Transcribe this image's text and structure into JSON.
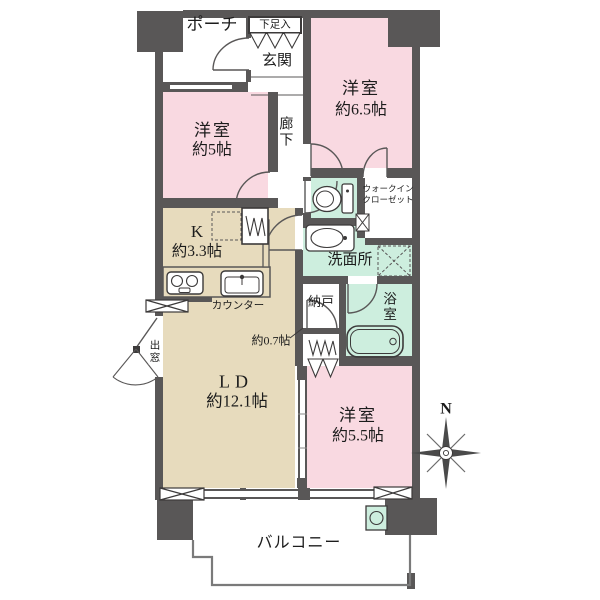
{
  "fp": {
    "rooms": {
      "porch": "ポーチ",
      "shoe_box": "下足入",
      "entrance": "玄関",
      "bedroom_ne_name": "洋室",
      "bedroom_ne_size": "約6.5帖",
      "bedroom_w_name": "洋室",
      "bedroom_w_size": "約5帖",
      "corridor": "廊下",
      "wic_line1": "ウォークイン",
      "wic_line2": "クローゼット",
      "washroom": "洗面所",
      "kitchen_name": "K",
      "kitchen_size": "約3.3帖",
      "counter": "カウンター",
      "storage": "納戸",
      "storage_size": "約0.7帖",
      "bath": "浴室",
      "living_name": "LD",
      "living_size": "約12.1帖",
      "bedroom_se_name": "洋室",
      "bedroom_se_size": "約5.5帖",
      "balcony": "バルコニー",
      "bay_window": "出窓",
      "compass_north": "N"
    },
    "colors": {
      "wall": "#595757",
      "bedroom_fill": "#f9d9e1",
      "wet_area_fill": "#cdeede",
      "living_fill": "#e7dbbd",
      "line": "#595757",
      "text": "#1c1c1c"
    }
  }
}
